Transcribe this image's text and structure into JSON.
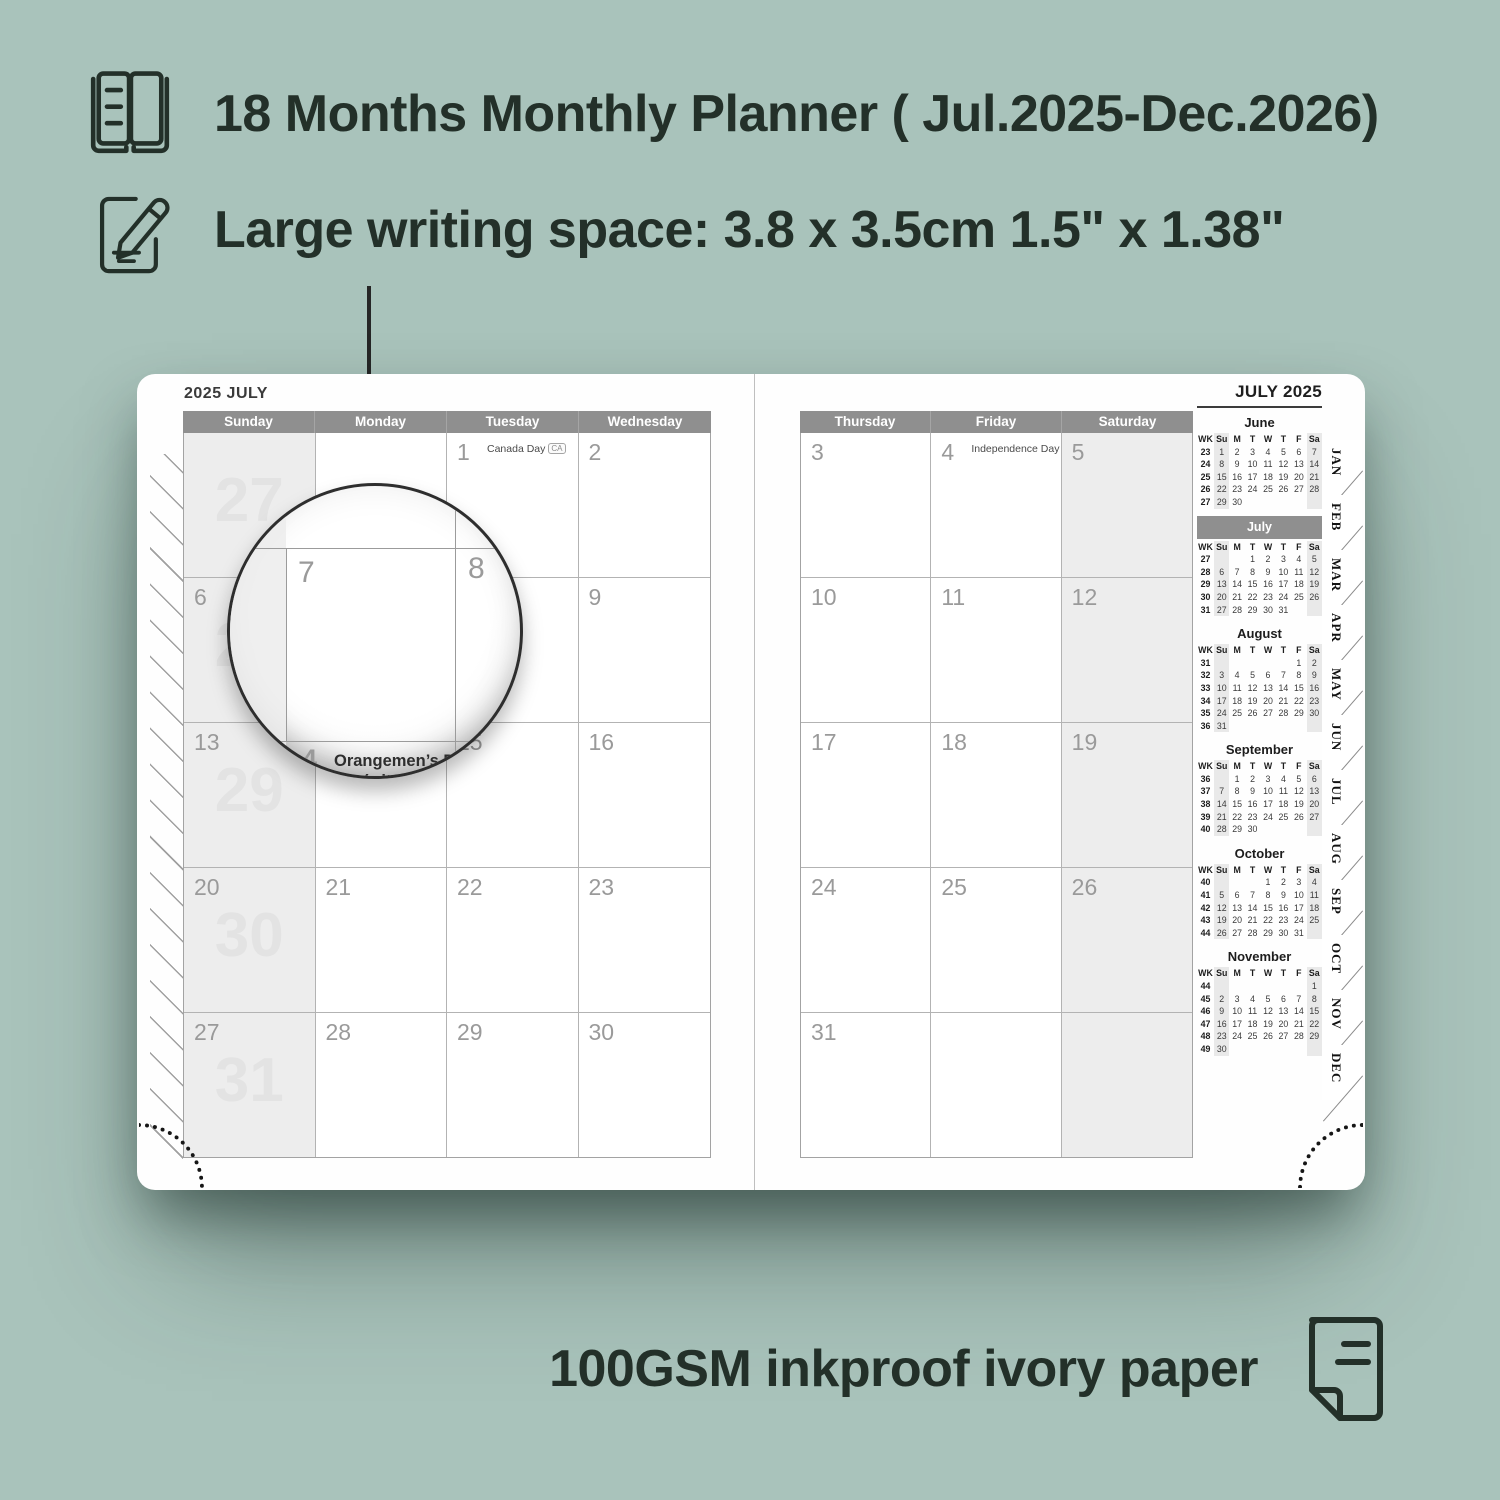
{
  "colors": {
    "background": "#a9c3bb",
    "ink": "#233029",
    "header_bar": "#8f8f8f",
    "shaded_cell": "#ededed",
    "date_number": "#9a9a9a",
    "watermark": "#e3e3e3",
    "grid_line": "#b3b3b3"
  },
  "features": {
    "top1": {
      "icon": "open-book-icon",
      "text": "18 Months Monthly Planner ( Jul.2025-Dec.2026)"
    },
    "top2": {
      "icon": "pencil-edit-icon",
      "text": "Large writing space: 3.8 x 3.5cm 1.5\" x 1.38\""
    },
    "bottom": {
      "icon": "paper-sheet-icon",
      "text": "100GSM inkproof ivory paper"
    }
  },
  "planner": {
    "left_page": {
      "title": "2025 JULY",
      "day_headers": [
        "Sunday",
        "Monday",
        "Tuesday",
        "Wednesday"
      ],
      "weeks": [
        {
          "watermark": "27",
          "cells": [
            {
              "date": ""
            },
            {
              "date": ""
            },
            {
              "date": "1",
              "event": "Canada Day",
              "badge": "CA"
            },
            {
              "date": "2"
            }
          ]
        },
        {
          "watermark": "28",
          "cells": [
            {
              "date": "6"
            },
            {
              "date": "7"
            },
            {
              "date": "8"
            },
            {
              "date": "9"
            }
          ]
        },
        {
          "watermark": "29",
          "cells": [
            {
              "date": "13"
            },
            {
              "date": "14"
            },
            {
              "date": "15"
            },
            {
              "date": "16"
            }
          ]
        },
        {
          "watermark": "30",
          "cells": [
            {
              "date": "20"
            },
            {
              "date": "21"
            },
            {
              "date": "22"
            },
            {
              "date": "23"
            }
          ]
        },
        {
          "watermark": "31",
          "cells": [
            {
              "date": "27"
            },
            {
              "date": "28"
            },
            {
              "date": "29"
            },
            {
              "date": "30"
            }
          ]
        }
      ]
    },
    "right_page": {
      "day_headers": [
        "Thursday",
        "Friday",
        "Saturday"
      ],
      "weeks": [
        {
          "cells": [
            {
              "date": "3"
            },
            {
              "date": "4",
              "event": "Independence Day",
              "badge": "US"
            },
            {
              "date": "5"
            }
          ]
        },
        {
          "cells": [
            {
              "date": "10"
            },
            {
              "date": "11"
            },
            {
              "date": "12"
            }
          ]
        },
        {
          "cells": [
            {
              "date": "17"
            },
            {
              "date": "18"
            },
            {
              "date": "19"
            }
          ]
        },
        {
          "cells": [
            {
              "date": "24"
            },
            {
              "date": "25"
            },
            {
              "date": "26"
            }
          ]
        },
        {
          "cells": [
            {
              "date": "31"
            },
            {
              "date": ""
            },
            {
              "date": ""
            }
          ]
        }
      ]
    },
    "side_panel": {
      "title": "JULY 2025",
      "week_header": [
        "WK",
        "Su",
        "M",
        "T",
        "W",
        "T",
        "F",
        "Sa"
      ],
      "months": [
        {
          "name": "June",
          "bar": false,
          "rows": [
            [
              "23",
              "1",
              "2",
              "3",
              "4",
              "5",
              "6",
              "7"
            ],
            [
              "24",
              "8",
              "9",
              "10",
              "11",
              "12",
              "13",
              "14"
            ],
            [
              "25",
              "15",
              "16",
              "17",
              "18",
              "19",
              "20",
              "21"
            ],
            [
              "26",
              "22",
              "23",
              "24",
              "25",
              "26",
              "27",
              "28"
            ],
            [
              "27",
              "29",
              "30",
              "",
              "",
              "",
              "",
              ""
            ]
          ]
        },
        {
          "name": "July",
          "bar": true,
          "rows": [
            [
              "27",
              "",
              "",
              "1",
              "2",
              "3",
              "4",
              "5"
            ],
            [
              "28",
              "6",
              "7",
              "8",
              "9",
              "10",
              "11",
              "12"
            ],
            [
              "29",
              "13",
              "14",
              "15",
              "16",
              "17",
              "18",
              "19"
            ],
            [
              "30",
              "20",
              "21",
              "22",
              "23",
              "24",
              "25",
              "26"
            ],
            [
              "31",
              "27",
              "28",
              "29",
              "30",
              "31",
              "",
              ""
            ]
          ]
        },
        {
          "name": "August",
          "bar": false,
          "rows": [
            [
              "31",
              "",
              "",
              "",
              "",
              "",
              "1",
              "2"
            ],
            [
              "32",
              "3",
              "4",
              "5",
              "6",
              "7",
              "8",
              "9"
            ],
            [
              "33",
              "10",
              "11",
              "12",
              "13",
              "14",
              "15",
              "16"
            ],
            [
              "34",
              "17",
              "18",
              "19",
              "20",
              "21",
              "22",
              "23"
            ],
            [
              "35",
              "24",
              "25",
              "26",
              "27",
              "28",
              "29",
              "30"
            ],
            [
              "36",
              "31",
              "",
              "",
              "",
              "",
              "",
              ""
            ]
          ]
        },
        {
          "name": "September",
          "bar": false,
          "rows": [
            [
              "36",
              "",
              "1",
              "2",
              "3",
              "4",
              "5",
              "6"
            ],
            [
              "37",
              "7",
              "8",
              "9",
              "10",
              "11",
              "12",
              "13"
            ],
            [
              "38",
              "14",
              "15",
              "16",
              "17",
              "18",
              "19",
              "20"
            ],
            [
              "39",
              "21",
              "22",
              "23",
              "24",
              "25",
              "26",
              "27"
            ],
            [
              "40",
              "28",
              "29",
              "30",
              "",
              "",
              "",
              ""
            ]
          ]
        },
        {
          "name": "October",
          "bar": false,
          "rows": [
            [
              "40",
              "",
              "",
              "",
              "1",
              "2",
              "3",
              "4"
            ],
            [
              "41",
              "5",
              "6",
              "7",
              "8",
              "9",
              "10",
              "11"
            ],
            [
              "42",
              "12",
              "13",
              "14",
              "15",
              "16",
              "17",
              "18"
            ],
            [
              "43",
              "19",
              "20",
              "21",
              "22",
              "23",
              "24",
              "25"
            ],
            [
              "44",
              "26",
              "27",
              "28",
              "29",
              "30",
              "31",
              ""
            ]
          ]
        },
        {
          "name": "November",
          "bar": false,
          "rows": [
            [
              "44",
              "",
              "",
              "",
              "",
              "",
              "",
              "1"
            ],
            [
              "45",
              "2",
              "3",
              "4",
              "5",
              "6",
              "7",
              "8"
            ],
            [
              "46",
              "9",
              "10",
              "11",
              "12",
              "13",
              "14",
              "15"
            ],
            [
              "47",
              "16",
              "17",
              "18",
              "19",
              "20",
              "21",
              "22"
            ],
            [
              "48",
              "23",
              "24",
              "25",
              "26",
              "27",
              "28",
              "29"
            ],
            [
              "49",
              "30",
              "",
              "",
              "",
              "",
              "",
              ""
            ]
          ]
        }
      ]
    },
    "tabs": [
      "JAN",
      "FEB",
      "MAR",
      "APR",
      "MAY",
      "JUN",
      "JUL",
      "AUG",
      "SEP",
      "OCT",
      "NOV",
      "DEC"
    ],
    "magnifier": {
      "day_a": "7",
      "day_b": "8",
      "event_date_partial": "4",
      "event_line1": "Orangemen’s Day",
      "event_line2": "(wit"
    }
  }
}
